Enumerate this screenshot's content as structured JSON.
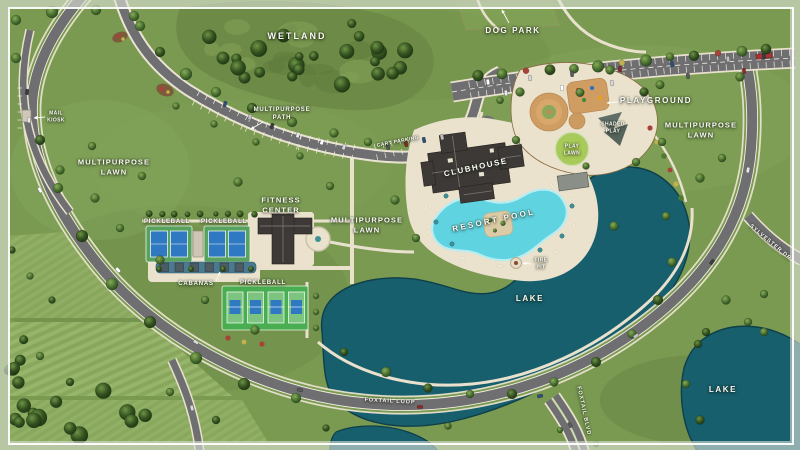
{
  "site": {
    "name": "community-amenity-site-plan",
    "labels": {
      "wetland": "WETLAND",
      "dog_park": "DOG PARK",
      "mail_kiosk": [
        "MAIL",
        "KIOSK"
      ],
      "multipurpose_path": [
        "MULTIPURPOSE",
        "PATH"
      ],
      "multipurpose_lawn": [
        "MULTIPURPOSE",
        "LAWN"
      ],
      "cart_parking": "CART PARKING",
      "clubhouse": "CLUBHOUSE",
      "playground": "PLAYGROUND",
      "shaded_play": [
        "SHADED",
        "PLAY"
      ],
      "play_lawn": [
        "PLAY",
        "LAWN"
      ],
      "fitness_center": [
        "FITNESS",
        "CENTER"
      ],
      "pickleball": "PICKLEBALL",
      "cabanas": "CABANAS",
      "resort_pool": "RESORT POOL",
      "fire_pit": [
        "FIRE",
        "PIT"
      ],
      "lake": "LAKE"
    },
    "roads": {
      "foxtail_loop": "FOXTAIL LOOP",
      "foxtail_blvd": "FOXTAIL BLVD",
      "sylvester_dr": "SYLVESTER DR"
    }
  },
  "colors": {
    "grass": "#7a9a52",
    "grass_light": "#96b56c",
    "wetland": "#6d8a46",
    "lake": "#175f6d",
    "lake_edge": "#0f3f4a",
    "pool": "#5fd4e0",
    "pool_edge": "#b9ecf1",
    "deck": "#eae2cd",
    "road": "#6f6f72",
    "road_line": "#f3efe2",
    "sidewalk": "#e9e1cd",
    "roof": "#3d3936",
    "roof_ridge": "#77706a",
    "sand": "#cf9d62",
    "mulch": "#7d5a3a",
    "court_pad": "#57a25e",
    "court_pad_bright": "#49ad52",
    "court_blue": "#2f78c2",
    "court_light": "#7cc47f",
    "play_lawn": "#a8ca58",
    "cabana": "#4d5b63",
    "water_feature": "#4a7a90",
    "accent_red": "#a8433a",
    "accent_yellow": "#c3b14e",
    "field_a": "#95b46a",
    "field_b": "#8cab60",
    "frame": "#ffffff",
    "label": "#fbfaf6"
  }
}
